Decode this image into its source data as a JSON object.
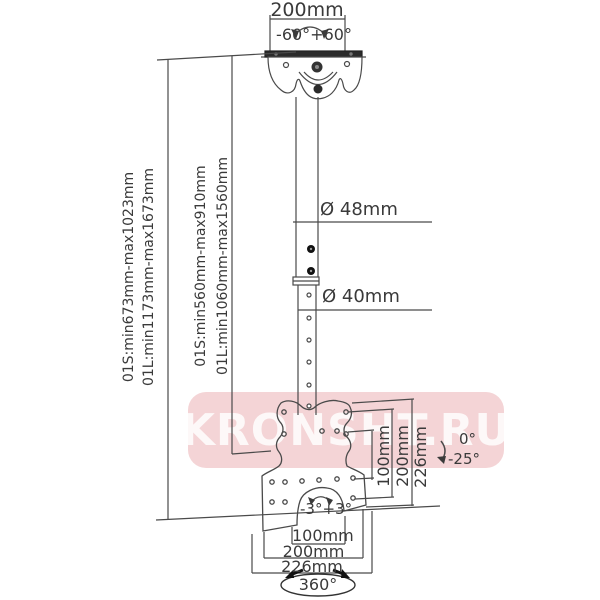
{
  "labels": {
    "top_width": "200mm",
    "swivel": "-60°+60°",
    "dia_upper": "Ø 48mm",
    "dia_lower": "Ø 40mm",
    "left_outer": [
      "01S:min673mm-max1023mm",
      "01L:min1173mm-max1673mm"
    ],
    "left_inner": [
      "01S:min560mm-max910mm",
      "01L:min1060mm-max1560mm"
    ],
    "vesa_vertical": [
      "100mm",
      "200mm",
      "226mm"
    ],
    "tilt": [
      "0°",
      "-25°"
    ],
    "plate_swivel": "-3°+3°",
    "bottom": [
      "100mm",
      "200mm",
      "226mm"
    ],
    "rotation": "360°"
  },
  "watermark": {
    "text": "KRONSHT.RU",
    "background": "#f2c9cb",
    "text_color": "#ffffff"
  },
  "colors": {
    "line": "#4a4a4a",
    "dark_fill": "#2b2b2b"
  }
}
